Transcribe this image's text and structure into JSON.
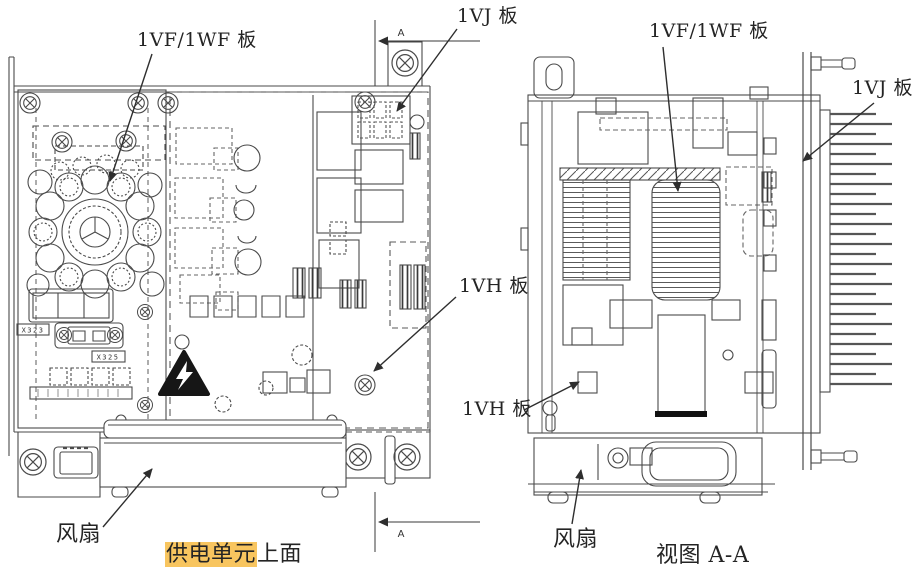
{
  "theme": {
    "paper": "#ffffff",
    "ink": "#242424",
    "line": "#4a4a4a",
    "highlight": "#f8c55f"
  },
  "views": {
    "section_marker": "A",
    "left": {
      "caption_highlight": "供电单元",
      "caption_rest": "上面",
      "labels": {
        "board_1vf_1wf": "1VF/1WF 板",
        "board_1vj": "1VJ 板",
        "board_1vh": "1VH 板",
        "fan": "风扇"
      },
      "part_marks": {
        "x323": "X323",
        "x325": "X325"
      }
    },
    "right": {
      "caption": "视图 A-A",
      "labels": {
        "board_1vf_1wf": "1VF/1WF 板",
        "board_1vj": "1VJ 板",
        "board_1vh": "1VH 板",
        "fan": "风扇"
      }
    }
  }
}
